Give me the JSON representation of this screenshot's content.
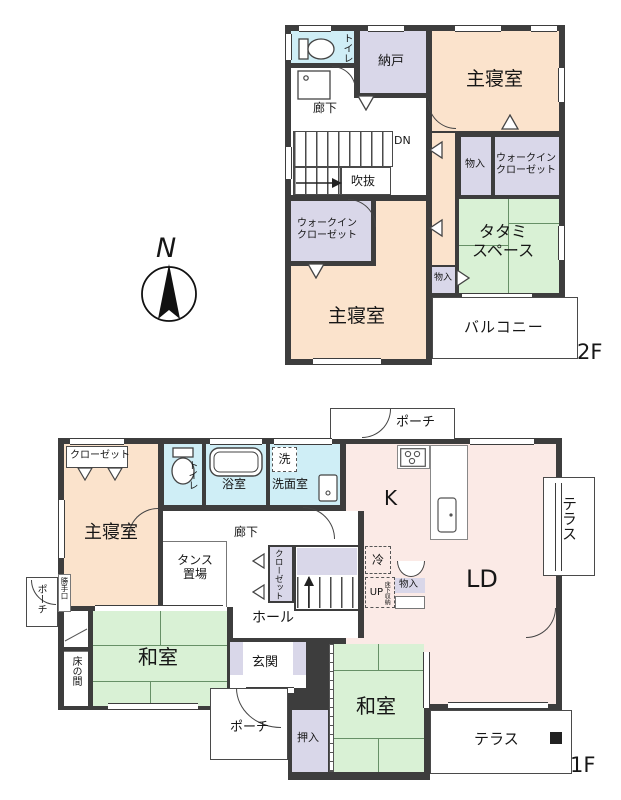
{
  "compass": {
    "label": "N"
  },
  "colors": {
    "wall": "#3d3d3d",
    "bedroom": "#fbe3cc",
    "storage": "#d9d7e9",
    "sanitary": "#cfeef6",
    "tatami": "#d9f1d5",
    "living": "#fbeae6",
    "tatami_line": "#679067"
  },
  "f2": {
    "floor_tag": "2F",
    "toilet": "トイレ",
    "storeroom": "納戸",
    "master_top": "主寝室",
    "corridor": "廊下",
    "stairs_dn": "DN",
    "void": "吹抜",
    "closet_a": "物入",
    "wic_right_l1": "ウォークイン",
    "wic_right_l2": "クローゼット",
    "tatami_l1": "タタミ",
    "tatami_l2": "スペース",
    "closet_b": "物入",
    "wic_left_l1": "ウォークイン",
    "wic_left_l2": "クローゼット",
    "master_bottom": "主寝室",
    "balcony": "バルコニー"
  },
  "f1": {
    "floor_tag": "1F",
    "closet_top": "クローゼット",
    "master": "主寝室",
    "toilet": "トイレ",
    "bath": "浴室",
    "laundry": "洗",
    "washroom": "洗面室",
    "porch_top": "ポーチ",
    "kitchen": "K",
    "corridor": "廊下",
    "tansu_l1": "タンス",
    "tansu_l2": "置場",
    "closet_mid": "クローゼット",
    "stairs_up": "UP",
    "underfloor": "床下収納",
    "fridge": "冷",
    "closet_k": "物入",
    "living": "LD",
    "terrace_right": "テラス",
    "back_door": "勝手口",
    "porch_left": "ポーチ",
    "tokonoma": "床の間",
    "washitsu_a": "和室",
    "hall": "ホール",
    "entrance": "玄関",
    "porch_bottom": "ポーチ",
    "oshiire": "押入",
    "washitsu_b": "和室",
    "terrace_bottom": "テラス"
  }
}
